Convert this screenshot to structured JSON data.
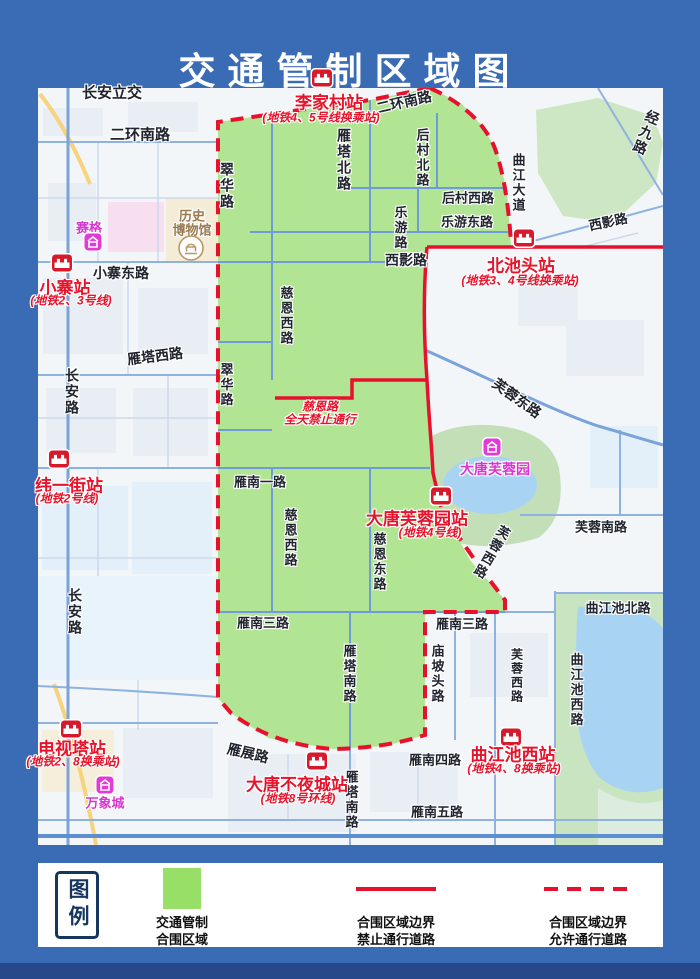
{
  "title": "交通管制区域图",
  "colors": {
    "frame_blue": "#3a6cb5",
    "zone_green": "#b1e593",
    "boundary_red": "#e8112d"
  },
  "map": {
    "stations": [
      {
        "name": "李家村站",
        "sub": "(地铁4、5号线换乘站)",
        "icon_x": 284,
        "icon_y": -10,
        "name_x": 291,
        "name_y": 13,
        "sub_x": 283,
        "sub_y": 29
      },
      {
        "name": "小寨站",
        "sub": "(地铁2、3号线)",
        "icon_x": 24,
        "icon_y": 175,
        "name_x": 27,
        "name_y": 198,
        "sub_x": 33,
        "sub_y": 212
      },
      {
        "name": "北池头站",
        "sub": "(地铁3、4号线换乘站)",
        "icon_x": 486,
        "icon_y": 150,
        "name_x": 483,
        "name_y": 176,
        "sub_x": 482,
        "sub_y": 192
      },
      {
        "name": "纬一街站",
        "sub": "(地铁2号线)",
        "icon_x": 21,
        "icon_y": 371,
        "name_x": 31,
        "name_y": 396,
        "sub_x": 29,
        "sub_y": 410
      },
      {
        "name": "大唐芙蓉园站",
        "sub": "(地铁4号线)",
        "icon_x": 403,
        "icon_y": 408,
        "name_x": 379,
        "name_y": 429,
        "sub_x": 392,
        "sub_y": 444
      },
      {
        "name": "电视塔站",
        "sub": "(地铁2、8换乘站)",
        "icon_x": 33,
        "icon_y": 641,
        "name_x": 34,
        "name_y": 659,
        "sub_x": 35,
        "sub_y": 673
      },
      {
        "name": "大唐不夜城站",
        "sub": "(地铁8号环线)",
        "icon_x": 279,
        "icon_y": 673,
        "name_x": 259,
        "name_y": 695,
        "sub_x": 260,
        "sub_y": 710
      },
      {
        "name": "曲江池西站",
        "sub": "(地铁4、8换乘站)",
        "icon_x": 473,
        "icon_y": 649,
        "name_x": 475,
        "name_y": 665,
        "sub_x": 476,
        "sub_y": 680
      }
    ],
    "road_labels": [
      {
        "text": "长安立交",
        "x": 74,
        "y": 4,
        "size": 15
      },
      {
        "text": "二环南路",
        "x": 102,
        "y": 46,
        "size": 15
      },
      {
        "text": "二环南路",
        "x": 366,
        "y": 14,
        "size": 14,
        "rot": -13
      },
      {
        "text": "雁塔北路",
        "x": 306,
        "y": 72,
        "size": 14,
        "v": true
      },
      {
        "text": "后村北路",
        "x": 384,
        "y": 70,
        "size": 13,
        "v": true
      },
      {
        "text": "经九路",
        "x": 608,
        "y": 45,
        "size": 14,
        "v": true,
        "rot": 22
      },
      {
        "text": "曲江大道",
        "x": 480,
        "y": 95,
        "size": 13,
        "v": true
      },
      {
        "text": "后村西路",
        "x": 430,
        "y": 109,
        "size": 13
      },
      {
        "text": "乐游东路",
        "x": 429,
        "y": 133,
        "size": 13
      },
      {
        "text": "乐游路",
        "x": 362,
        "y": 140,
        "size": 13,
        "v": true
      },
      {
        "text": "西影路",
        "x": 368,
        "y": 172,
        "size": 14
      },
      {
        "text": "西影路",
        "x": 570,
        "y": 133,
        "size": 13,
        "rot": -12
      },
      {
        "text": "小寨东路",
        "x": 83,
        "y": 185,
        "size": 14
      },
      {
        "text": "翠华路",
        "x": 189,
        "y": 98,
        "size": 14,
        "v": true
      },
      {
        "text": "慈恩西路",
        "x": 248,
        "y": 228,
        "size": 13,
        "v": true
      },
      {
        "text": "雁塔西路",
        "x": 117,
        "y": 268,
        "size": 14,
        "rot": -7
      },
      {
        "text": "长安路",
        "x": 34,
        "y": 304,
        "size": 14,
        "v": true
      },
      {
        "text": "翠华路",
        "x": 188,
        "y": 297,
        "size": 13,
        "v": true
      },
      {
        "text": "芙蓉东路",
        "x": 479,
        "y": 310,
        "size": 14,
        "rot": 36
      },
      {
        "text": "雁南一路",
        "x": 222,
        "y": 393,
        "size": 13
      },
      {
        "text": "慈恩西路",
        "x": 252,
        "y": 450,
        "size": 13,
        "v": true
      },
      {
        "text": "长安路",
        "x": 37,
        "y": 524,
        "size": 14,
        "v": true
      },
      {
        "text": "慈恩东路",
        "x": 341,
        "y": 474,
        "size": 13,
        "v": true
      },
      {
        "text": "芙蓉西路",
        "x": 453,
        "y": 464,
        "size": 13,
        "v": true,
        "rot": 30
      },
      {
        "text": "芙蓉南路",
        "x": 563,
        "y": 438,
        "size": 13
      },
      {
        "text": "雁南三路",
        "x": 225,
        "y": 534,
        "size": 13
      },
      {
        "text": "雁南三路",
        "x": 424,
        "y": 535,
        "size": 13
      },
      {
        "text": "庙坡头路",
        "x": 399,
        "y": 586,
        "size": 13,
        "v": true
      },
      {
        "text": "雁塔南路",
        "x": 311,
        "y": 586,
        "size": 13,
        "v": true
      },
      {
        "text": "曲江池北路",
        "x": 580,
        "y": 519,
        "size": 13
      },
      {
        "text": "芙蓉西路",
        "x": 479,
        "y": 588,
        "size": 12,
        "v": true
      },
      {
        "text": "曲江池西路",
        "x": 538,
        "y": 602,
        "size": 13,
        "v": true
      },
      {
        "text": "雁展路",
        "x": 210,
        "y": 665,
        "size": 14,
        "rot": 13
      },
      {
        "text": "雁南四路",
        "x": 397,
        "y": 671,
        "size": 13
      },
      {
        "text": "雁塔南路",
        "x": 313,
        "y": 712,
        "size": 13,
        "v": true
      },
      {
        "text": "雁南五路",
        "x": 399,
        "y": 723,
        "size": 13
      }
    ],
    "notice": {
      "line1": "慈恩路",
      "line2": "全天禁止通行",
      "x": 282,
      "y1": 318,
      "y2": 331
    },
    "landmarks": [
      {
        "text": "赛格",
        "x": 51,
        "y": 139,
        "icon_x": 55,
        "icon_y": 154,
        "kind": "mall"
      },
      {
        "text": "历史",
        "text2": "博物馆",
        "x": 154,
        "y": 127,
        "y2": 141,
        "icon_x": 153,
        "icon_y": 160,
        "kind": "museum"
      },
      {
        "text": "大唐芙蓉园",
        "x": 457,
        "y": 381,
        "icon_x": 454,
        "icon_y": 359,
        "kind": "park"
      },
      {
        "text": "万象城",
        "x": 67,
        "y": 714,
        "icon_x": 67,
        "icon_y": 697,
        "kind": "mall"
      }
    ]
  },
  "legend": {
    "title": "图例",
    "items": [
      {
        "line1": "交通管制",
        "line2": "合围区域"
      },
      {
        "line1": "合围区域边界",
        "line2": "禁止通行道路"
      },
      {
        "line1": "合围区域边界",
        "line2": "允许通行道路"
      }
    ]
  }
}
